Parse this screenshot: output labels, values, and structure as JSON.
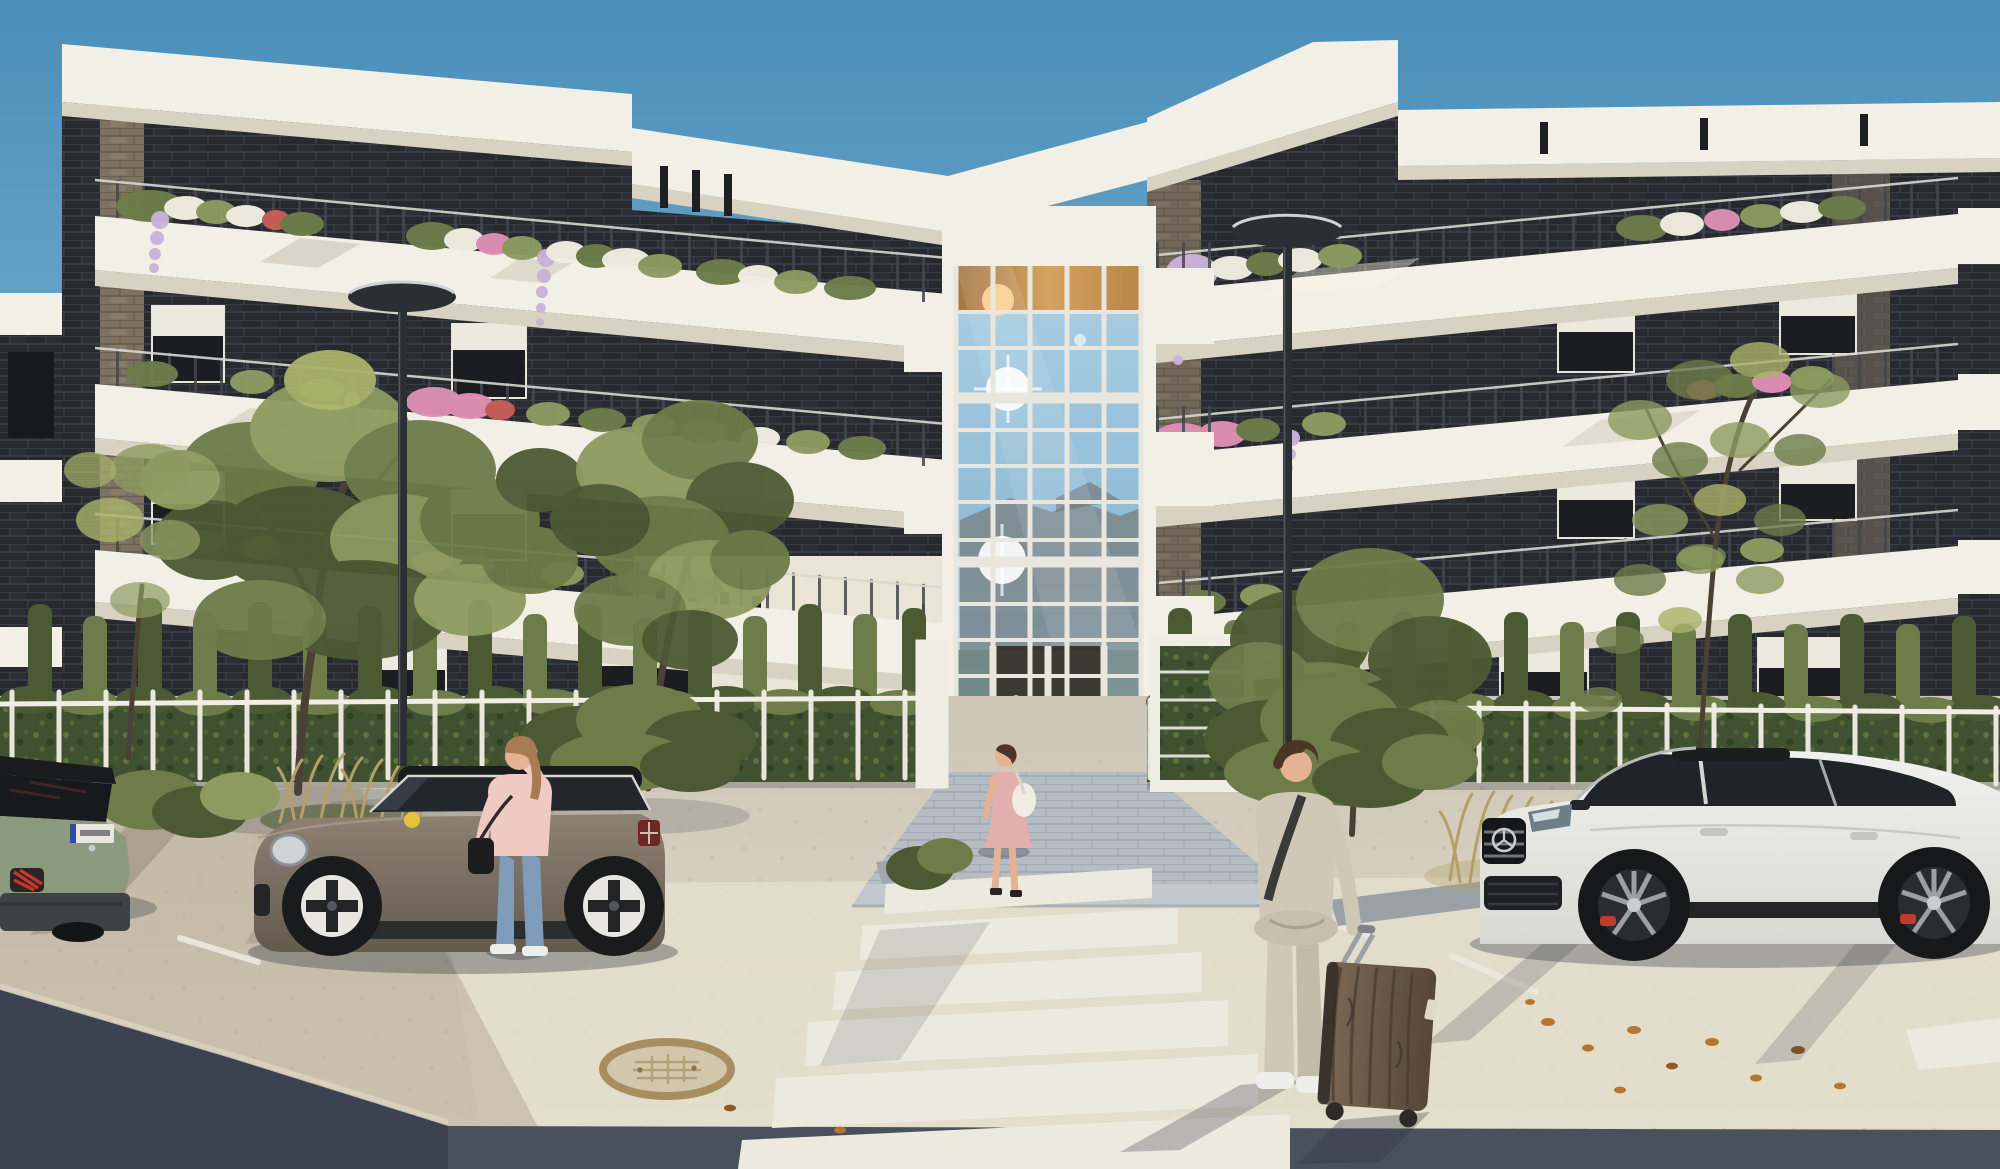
{
  "meta": {
    "kind": "architectural-exterior-rendering",
    "setting": "modern four-story apartment complex, street-level view, clear day",
    "time_of_day": "late afternoon sun from the right"
  },
  "scene": {
    "building": {
      "stories": 4,
      "facade": "dark charcoal brick with white concrete roof slabs and white balconies",
      "features": [
        "full-height central glass atrium entrance with white mullions",
        "balcony planters with white, pink and red flowers",
        "hanging lilac wisteria",
        "white vertical-post fence with green hedge",
        "slender hedge columns",
        "roller-shade windows"
      ]
    },
    "vehicles": [
      {
        "name": "compact-suv-rear",
        "color": "sage-green",
        "position": "left edge, rear view",
        "details": "red claw taillight, white EU plate with blue band, dark bumper"
      },
      {
        "name": "mini-hatchback",
        "color": "bronze-brown with black roof",
        "position": "parked left of entrance",
        "details": "yellow mirror cap, white cross-spoke wheels, union-jack taillight"
      },
      {
        "name": "suv-coupe",
        "color": "white",
        "position": "parked right",
        "details": "black grille with star emblem, cross-spoke alloy wheels, red brake calipers, black running board"
      }
    ],
    "people": [
      {
        "name": "woman-on-phone",
        "clothing": "pink sweater, blue jeans, white sneakers",
        "accessory": "white phone at ear, small black handbag",
        "position": "standing beside mini-hatchback"
      },
      {
        "name": "woman-walking-to-entrance",
        "clothing": "pink dress, heels",
        "accessory": "white shoulder bag",
        "position": "on entrance path walking toward glass doors"
      },
      {
        "name": "man-with-suitcase",
        "clothing": "beige suit, white sneakers, dark crossbody strap",
        "accessory": "wood-grain rolling suitcase",
        "position": "foreground right, walking toward entrance"
      }
    ],
    "street": {
      "crosswalk": "white zebra stripes leading from foreground to entrance path",
      "pavement": "pale beige concrete with scattered orange leaves",
      "asphalt": "dark blue-grey band along bottom edge in shadow",
      "manhole": "round tan manhole cover lower left of crosswalk",
      "lamps": 2,
      "parking_lines": "short white diagonal lines"
    },
    "vegetation": [
      "two leafy trees in front of left wing",
      "bushy tree right of entrance",
      "tall sparse tree behind white suv-coupe",
      "ornamental tan grasses",
      "low green shrubs in planter beds"
    ]
  },
  "palette": {
    "sky_top": "#4a8eb9",
    "sky_bottom": "#8abcd7",
    "struct_white": "#f2efe6",
    "soffit": "#d8d2c2",
    "warm_white": "#eae4d6",
    "brick_dark": "#27292e",
    "brick_line": "#3e434c",
    "brick_tan": "#7d7261",
    "brick_tan_line": "#5f5546",
    "mullion": "#e9e6dd",
    "glass_top": "#a9cfe3",
    "glass_mid": "#8fbad5",
    "glass_low": "#bcd9e7",
    "glass_amber": "#d8a05c",
    "atrium_interior": "#342c24",
    "lamp_glow": "#f4c078",
    "hedge": "#3f5130",
    "hedge_light": "#66793f",
    "fol_dark": "#4c5a33",
    "fol_mid": "#6d7c49",
    "fol_light": "#8d9a60",
    "fol_pale": "#a9b36a",
    "flw_white": "#f1eee1",
    "flw_pink": "#dd8fb4",
    "flw_red": "#c75f57",
    "wisteria": "#c9b3da",
    "trunk": "#4a4034",
    "grass_tan": "#b3a068",
    "fence_white": "#f0ede4",
    "pave_top": "#cdc6b6",
    "pave_bottom": "#e2dccc",
    "paver": "#b5bcc3",
    "paver_line": "#939aa1",
    "asphalt": "#49505e",
    "asphalt_dark": "#3b4250",
    "stripe": "#ece9df",
    "mini_body_top": "#8d8173",
    "mini_body_bottom": "#635a4e",
    "mini_roof": "#1a1b1d",
    "wheel_face": "#e8e6e1",
    "mini_yellow": "#e2c43c",
    "peugeot_green": "#8b997c",
    "peugeot_dark": "#3f4244",
    "tail_red": "#c4372e",
    "plate_white": "#e8e6df",
    "plate_blue": "#2b4fa0",
    "merc_top": "#f1f1ef",
    "merc_bottom": "#d8d8d4",
    "merc_dark": "#202327",
    "merc_grille": "#15171a",
    "caliper_red": "#c03b2f",
    "rim_gray": "#9aa0a5",
    "skin": "#e6b294",
    "hair_auburn": "#a97b52",
    "hair_dark": "#4b3526",
    "pink_top": "#eecac3",
    "pink_dress": "#e2aeae",
    "jeans": "#7f9cba",
    "sneaker_white": "#eeeeea",
    "suit_beige": "#cfc8b6",
    "strap_dark": "#3a3a38",
    "wood_light": "#7c6954",
    "wood_dark": "#564739",
    "case_dark": "#2e2a26",
    "lamp_dark": "#2b2e32",
    "shadow": "#2e3440",
    "manhole_ring": "#a78e5f",
    "manhole_face": "#d2c7ab",
    "leaf_orange": "#b5772f"
  }
}
